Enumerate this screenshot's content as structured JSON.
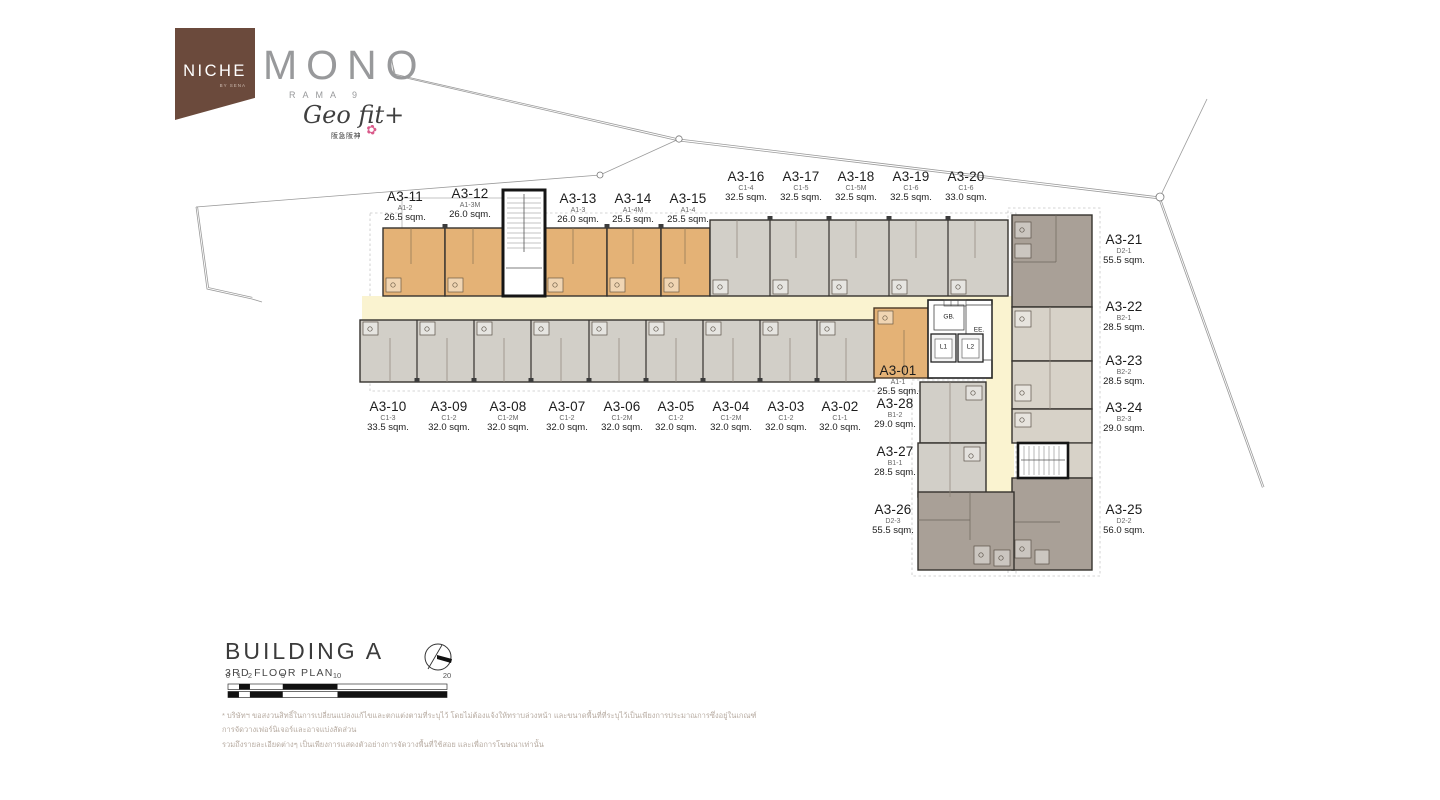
{
  "logo": {
    "niche": "NICHE",
    "niche_sub": "BY SENA",
    "mono": "MONO",
    "rama": "RAMA 9",
    "geofit": "Geo fit+",
    "geofit_sub": "阪急阪神",
    "flower_mark": "✿"
  },
  "title": {
    "building": "BUILDING A",
    "floor": "3RD FLOOR PLAN"
  },
  "core": {
    "gb": "GB.",
    "ee": "EE.",
    "l1": "L1",
    "l2": "L2"
  },
  "scale": {
    "ticks": [
      {
        "label": "0",
        "x": 228
      },
      {
        "label": "1",
        "x": 239
      },
      {
        "label": "2",
        "x": 250
      },
      {
        "label": "5",
        "x": 283
      },
      {
        "label": "10",
        "x": 337
      },
      {
        "label": "20",
        "x": 447
      }
    ]
  },
  "disclaimer": {
    "line1": "* บริษัทฯ ขอสงวนสิทธิ์ในการเปลี่ยนแปลงแก้ไขและตกแต่งตามที่ระบุไว้ โดยไม่ต้องแจ้งให้ทราบล่วงหน้า และขนาดพื้นที่ที่ระบุไว้เป็นเพียงการประมาณการซึ่งอยู่ในเกณฑ์การจัดวางเฟอร์นิเจอร์และอาจแบ่งสัดส่วน",
    "line2": "รวมถึงรายละเอียดต่างๆ เป็นเพียงการแสดงตัวอย่างการจัดวางพื้นที่ใช้สอย และเพื่อการโฆษณาเท่านั้น"
  },
  "colors": {
    "brand-brown": "#6b4a3c",
    "brand-gray": "#98999b",
    "unit-orange": "#e4b276",
    "unit-gray": "#d2cfc8",
    "unit-taupe-dark": "#a9a097",
    "unit-taupe-light": "#d7d2c8",
    "corridor-yellow": "#faf3d0",
    "wall-dark": "#35322e"
  },
  "units": [
    {
      "unit": "A3-11",
      "type": "A1-2",
      "area": "26.5 sqm.",
      "x": 405,
      "y": 190
    },
    {
      "unit": "A3-12",
      "type": "A1-3M",
      "area": "26.0 sqm.",
      "x": 470,
      "y": 187
    },
    {
      "unit": "A3-13",
      "type": "A1-3",
      "area": "26.0 sqm.",
      "x": 578,
      "y": 192
    },
    {
      "unit": "A3-14",
      "type": "A1-4M",
      "area": "25.5 sqm.",
      "x": 633,
      "y": 192
    },
    {
      "unit": "A3-15",
      "type": "A1-4",
      "area": "25.5 sqm.",
      "x": 688,
      "y": 192
    },
    {
      "unit": "A3-16",
      "type": "C1-4",
      "area": "32.5 sqm.",
      "x": 746,
      "y": 170
    },
    {
      "unit": "A3-17",
      "type": "C1-5",
      "area": "32.5 sqm.",
      "x": 801,
      "y": 170
    },
    {
      "unit": "A3-18",
      "type": "C1-5M",
      "area": "32.5 sqm.",
      "x": 856,
      "y": 170
    },
    {
      "unit": "A3-19",
      "type": "C1-6",
      "area": "32.5 sqm.",
      "x": 911,
      "y": 170
    },
    {
      "unit": "A3-20",
      "type": "C1-6",
      "area": "33.0 sqm.",
      "x": 966,
      "y": 170
    },
    {
      "unit": "A3-10",
      "type": "C1-3",
      "area": "33.5 sqm.",
      "x": 388,
      "y": 400
    },
    {
      "unit": "A3-09",
      "type": "C1-2",
      "area": "32.0 sqm.",
      "x": 449,
      "y": 400
    },
    {
      "unit": "A3-08",
      "type": "C1-2M",
      "area": "32.0 sqm.",
      "x": 508,
      "y": 400
    },
    {
      "unit": "A3-07",
      "type": "C1-2",
      "area": "32.0 sqm.",
      "x": 567,
      "y": 400
    },
    {
      "unit": "A3-06",
      "type": "C1-2M",
      "area": "32.0 sqm.",
      "x": 622,
      "y": 400
    },
    {
      "unit": "A3-05",
      "type": "C1-2",
      "area": "32.0 sqm.",
      "x": 676,
      "y": 400
    },
    {
      "unit": "A3-04",
      "type": "C1-2M",
      "area": "32.0 sqm.",
      "x": 731,
      "y": 400
    },
    {
      "unit": "A3-03",
      "type": "C1-2",
      "area": "32.0 sqm.",
      "x": 786,
      "y": 400
    },
    {
      "unit": "A3-02",
      "type": "C1-1",
      "area": "32.0 sqm.",
      "x": 840,
      "y": 400
    },
    {
      "unit": "A3-01",
      "type": "A1-1",
      "area": "25.5 sqm.",
      "x": 898,
      "y": 364
    },
    {
      "unit": "A3-28",
      "type": "B1-2",
      "area": "29.0 sqm.",
      "x": 895,
      "y": 397
    },
    {
      "unit": "A3-27",
      "type": "B1-1",
      "area": "28.5 sqm.",
      "x": 895,
      "y": 445
    },
    {
      "unit": "A3-26",
      "type": "D2-3",
      "area": "55.5 sqm.",
      "x": 893,
      "y": 503
    },
    {
      "unit": "A3-21",
      "type": "D2-1",
      "area": "55.5 sqm.",
      "x": 1124,
      "y": 233
    },
    {
      "unit": "A3-22",
      "type": "B2-1",
      "area": "28.5 sqm.",
      "x": 1124,
      "y": 300
    },
    {
      "unit": "A3-23",
      "type": "B2-2",
      "area": "28.5 sqm.",
      "x": 1124,
      "y": 354
    },
    {
      "unit": "A3-24",
      "type": "B2-3",
      "area": "29.0 sqm.",
      "x": 1124,
      "y": 401
    },
    {
      "unit": "A3-25",
      "type": "D2-2",
      "area": "56.0 sqm.",
      "x": 1124,
      "y": 503
    }
  ]
}
